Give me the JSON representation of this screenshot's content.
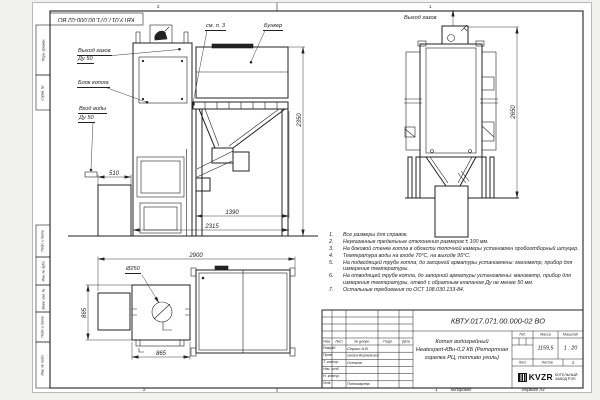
{
  "canvas": {
    "background": "#f1f1f0",
    "sheet": "#ffffff",
    "ink": "#222222"
  },
  "stamp_top": "КВТУ.017.071.00.000-02 ВО",
  "zones": {
    "top_left": "2",
    "top_right": "1",
    "bottom_left": "2",
    "bottom_right": "1"
  },
  "margin_fields": [
    "Перв. примен.",
    "Справ. №",
    "Подп. и дата",
    "Инв. № дубл.",
    "Взам. инв. №",
    "Подп. и дата",
    "Инв. № подл."
  ],
  "callouts": {
    "gas_out": "Выход газов",
    "gas_out_dn": "Ду 50",
    "boiler_block": "Блок котла",
    "water_in": "Вход воды",
    "water_in_dn": "Ду 50",
    "see_note": "см. п. 3",
    "bunker": "Бункер",
    "gas_out_back": "Выход газов"
  },
  "dims": {
    "front_height": "2350",
    "ash_box_depth": "510",
    "feed_span": "1390",
    "total_depth": "2315",
    "plan_width": "2900",
    "burner_dia": "Ø250",
    "plan_side": "865",
    "plan_front": "865",
    "back_height": "2650"
  },
  "notes": [
    {
      "n": "1.",
      "t": "Все размеры для справок."
    },
    {
      "n": "2.",
      "t": "Неуказанные предельные отклонения размеров ± 100 мм."
    },
    {
      "n": "3.",
      "t": "На боковой стенке котла в области топочной камеры установлен пробоотборный штуцер."
    },
    {
      "n": "4.",
      "t": "Температура воды на входе 70°С, на выходе 95°С."
    },
    {
      "n": "5.",
      "t": "На подводящей трубе котла, до запорной арматуры установлены: манометр, прибор для измерения температуры."
    },
    {
      "n": "6.",
      "t": "На отводящей трубе котла, до запорной арматуры установлены: манометр, прибор для измерения температуры, отвод с обратным клапаном Ду не менее 50 мм."
    },
    {
      "n": "7.",
      "t": "Остальные требования по ОСТ 108.030.133-84."
    }
  ],
  "title_block": {
    "doc_number": "КВТУ.017.071.00.000-02 ВО",
    "name_line1": "Котел водогрейный",
    "name_line2": "Heatexpert-КВн-0,2 КБ (Ретортная",
    "name_line3": "горелка РЦ, топливо уголь)",
    "headers": {
      "izm": "Изм.",
      "list": "Лист",
      "docum": "№ докум.",
      "podp": "Подп.",
      "data": "Дата",
      "lit": "Лит.",
      "massa": "Масса",
      "masshtab": "Масштаб",
      "list2": "Лист",
      "listov": "Листов"
    },
    "rows": [
      {
        "label": "Разраб.",
        "name": "Сергин А.В."
      },
      {
        "label": "Пров.",
        "name": "Онегов-Вережинский"
      },
      {
        "label": "Т. контр.",
        "name": "Осечкин"
      },
      {
        "label": "Нач. отд.",
        "name": ""
      },
      {
        "label": "Н. контр.",
        "name": ""
      },
      {
        "label": "Утв.",
        "name": "Пономарева"
      }
    ],
    "massa_value": "1159,5",
    "scale_value": "1 : 20",
    "listov_value": "1",
    "logo": {
      "brand": "KVZR",
      "sub1": "КОТЕЛЬНЫЙ",
      "sub2": "ЗАВОД РЭП"
    }
  },
  "footer": {
    "copied": "Копировал",
    "format": "Формат А3"
  }
}
